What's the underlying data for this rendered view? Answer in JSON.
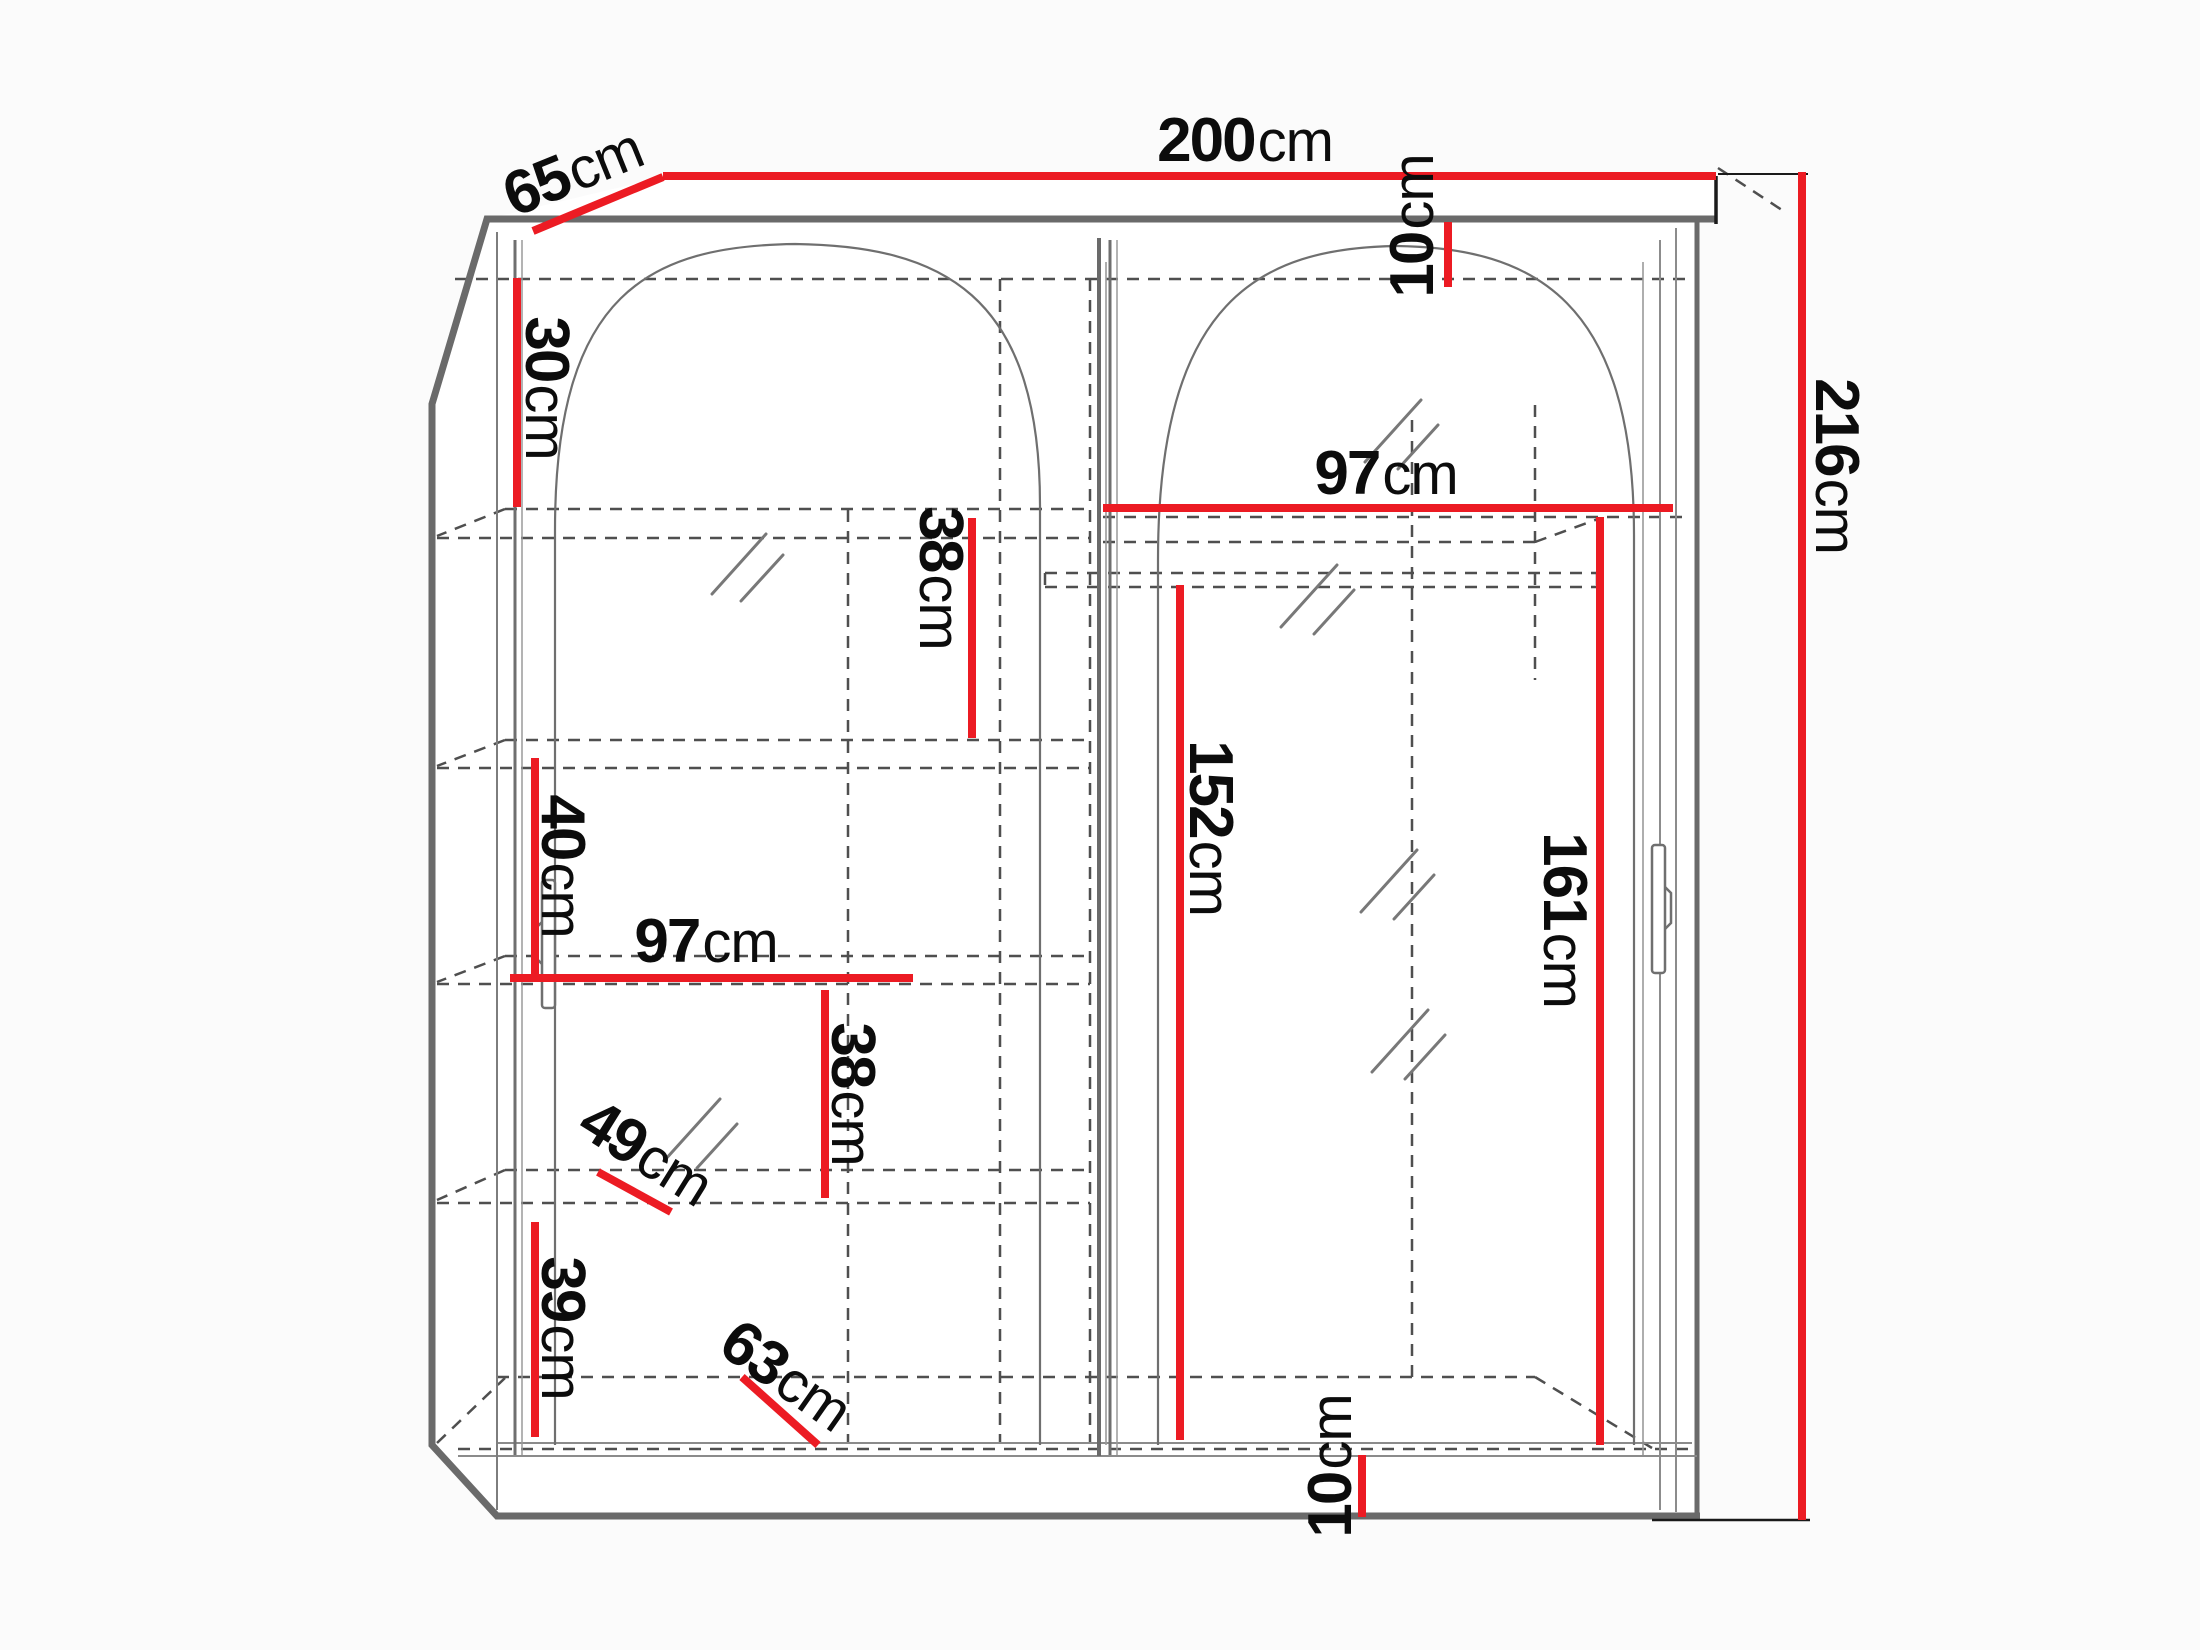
{
  "diagram": {
    "title": "wardrobe-dimension-diagram",
    "unit": "cm",
    "canvas": {
      "width": 2200,
      "height": 1650
    }
  },
  "colors": {
    "dimension_red": "#ec1b23",
    "structure_gray": "#6a6a6a",
    "dash_gray": "#4f4f4f",
    "text_black": "#0c0c0c",
    "background": "#fbfbfb"
  },
  "dimensions": [
    {
      "id": "width-total",
      "num": "200",
      "unit": "cm",
      "label": {
        "x": 1245,
        "y": 141,
        "rot": 0
      },
      "line": {
        "x1": 663,
        "y1": 176,
        "x2": 1716,
        "y2": 176
      }
    },
    {
      "id": "depth-total",
      "num": "65",
      "unit": "cm",
      "label": {
        "x": 573,
        "y": 172,
        "rot": -22
      },
      "line": {
        "x1": 533,
        "y1": 231,
        "x2": 663,
        "y2": 177
      }
    },
    {
      "id": "height-total",
      "num": "216",
      "unit": "cm",
      "label": {
        "x": 1836,
        "y": 466,
        "rot": 90
      },
      "line": {
        "x1": 1802,
        "y1": 172,
        "x2": 1802,
        "y2": 1520
      }
    },
    {
      "id": "top-panel",
      "num": "10",
      "unit": "cm",
      "label": {
        "x": 1413,
        "y": 226,
        "rot": -90
      },
      "line": {
        "x1": 1448,
        "y1": 222,
        "x2": 1448,
        "y2": 287
      }
    },
    {
      "id": "right-inner-width",
      "num": "97",
      "unit": "cm",
      "label": {
        "x": 1386,
        "y": 474,
        "rot": 0
      },
      "line": {
        "x1": 1103,
        "y1": 508,
        "x2": 1673,
        "y2": 508
      }
    },
    {
      "id": "right-hang-height",
      "num": "152",
      "unit": "cm",
      "label": {
        "x": 1210,
        "y": 828,
        "rot": 90
      },
      "line": {
        "x1": 1180,
        "y1": 585,
        "x2": 1180,
        "y2": 1440
      }
    },
    {
      "id": "right-door-height",
      "num": "161",
      "unit": "cm",
      "label": {
        "x": 1564,
        "y": 920,
        "rot": 90
      },
      "line": {
        "x1": 1600,
        "y1": 517,
        "x2": 1600,
        "y2": 1445
      }
    },
    {
      "id": "left-top-shelf",
      "num": "30",
      "unit": "cm",
      "label": {
        "x": 546,
        "y": 388,
        "rot": 90
      },
      "line": {
        "x1": 517,
        "y1": 278,
        "x2": 517,
        "y2": 507
      }
    },
    {
      "id": "left-shelf-gap-1",
      "num": "38",
      "unit": "cm",
      "label": {
        "x": 940,
        "y": 578,
        "rot": 90
      },
      "line": {
        "x1": 972,
        "y1": 518,
        "x2": 972,
        "y2": 738
      }
    },
    {
      "id": "left-shelf-gap-2",
      "num": "40",
      "unit": "cm",
      "label": {
        "x": 562,
        "y": 866,
        "rot": 90
      },
      "line": {
        "x1": 535,
        "y1": 758,
        "x2": 535,
        "y2": 975
      }
    },
    {
      "id": "left-inner-width",
      "num": "97",
      "unit": "cm",
      "label": {
        "x": 706,
        "y": 942,
        "rot": 0
      },
      "line": {
        "x1": 510,
        "y1": 978,
        "x2": 913,
        "y2": 978
      }
    },
    {
      "id": "left-shelf-gap-3",
      "num": "38",
      "unit": "cm",
      "label": {
        "x": 852,
        "y": 1094,
        "rot": 90
      },
      "line": {
        "x1": 825,
        "y1": 990,
        "x2": 825,
        "y2": 1198
      }
    },
    {
      "id": "shelf-depth-diag",
      "num": "49",
      "unit": "cm",
      "label": {
        "x": 646,
        "y": 1153,
        "rot": 32
      },
      "line": {
        "x1": 598,
        "y1": 1172,
        "x2": 671,
        "y2": 1212
      }
    },
    {
      "id": "left-bottom-gap",
      "num": "39",
      "unit": "cm",
      "label": {
        "x": 562,
        "y": 1328,
        "rot": 90
      },
      "line": {
        "x1": 535,
        "y1": 1222,
        "x2": 535,
        "y2": 1437
      }
    },
    {
      "id": "bottom-depth-diag",
      "num": "63",
      "unit": "cm",
      "label": {
        "x": 786,
        "y": 1376,
        "rot": 35
      },
      "line": {
        "x1": 742,
        "y1": 1377,
        "x2": 818,
        "y2": 1445
      }
    },
    {
      "id": "plinth-height",
      "num": "10",
      "unit": "cm",
      "label": {
        "x": 1331,
        "y": 1466,
        "rot": -90
      },
      "line": {
        "x1": 1362,
        "y1": 1455,
        "x2": 1362,
        "y2": 1517
      }
    }
  ]
}
